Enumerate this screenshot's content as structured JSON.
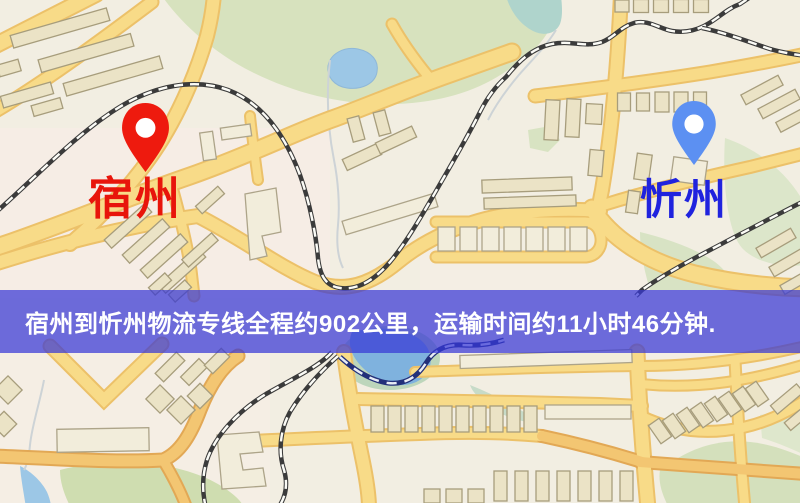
{
  "banner": {
    "text": "宿州到忻州物流专线全程约902公里，运输时间约11小时46分钟.",
    "background_color": "rgba(56,56,214,0.72)",
    "text_color": "#FFFFFF"
  },
  "map": {
    "origin": {
      "label": "宿州",
      "pin_icon": "red-location-pin",
      "pin_color": "#EE1A0E",
      "label_color": "#E8150B"
    },
    "destination": {
      "label": "忻州",
      "pin_icon": "blue-location-pin",
      "pin_color": "#5C90F2",
      "label_color": "#2023DE"
    }
  },
  "route_info": {
    "origin": "宿州",
    "destination": "忻州",
    "service": "物流专线",
    "distance": "约902公里",
    "duration": "约11小时46分钟"
  }
}
